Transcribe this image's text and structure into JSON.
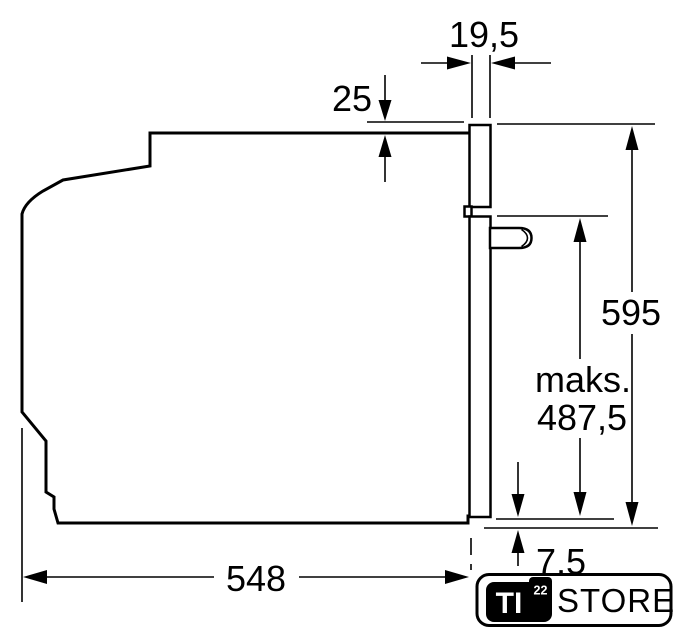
{
  "dimensions": {
    "fascia_thickness": "19,5",
    "top_overlap": "25",
    "total_height": "595",
    "max_prefix": "maks.",
    "max_height": "487,5",
    "depth": "548",
    "bottom_overlap": "7,5"
  },
  "logo": {
    "ti": "TI",
    "exp": "22",
    "store": "STORE"
  },
  "colors": {
    "line": "#000000",
    "background": "#ffffff"
  }
}
